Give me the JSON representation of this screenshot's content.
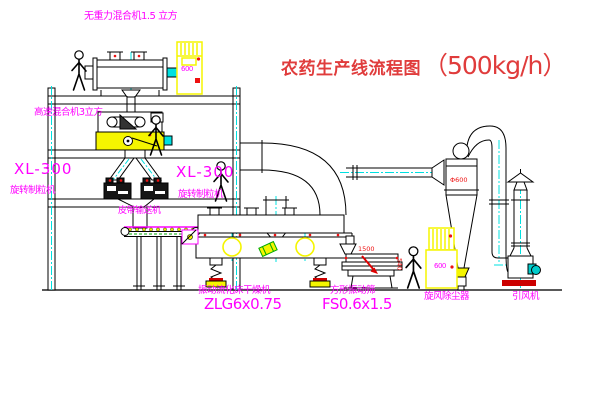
{
  "title": {
    "text": "农药生产线流程图",
    "capacity": "（500kg/h）"
  },
  "labels": {
    "gravity_mixer": "无重力混合机1.5 立方",
    "high_speed_mixer": "高速混合机3立方",
    "granulator_left_model": "XL-300",
    "granulator_left": "旋转制粒机",
    "granulator_mid_model": "XL-300",
    "granulator_mid": "旋转制粒机",
    "belt_conveyor": "皮带输送机",
    "dryer": "振动流化床干燥机",
    "dryer_model": "ZLG6x0.75",
    "sieve": "方形振动筛",
    "sieve_model": "FS0.6x1.5",
    "cyclone": "旋风除尘器",
    "fan": "引风机"
  },
  "dimensions": {
    "cyclone_dia": "Φ600",
    "sieve_len": "1500",
    "sieve_h": "540"
  },
  "cabinets": {
    "cabinet1": "600",
    "cabinet2": "600"
  },
  "colors": {
    "label_magenta": "#ff00ff",
    "title_red": "#e03c3c",
    "dim_red": "#ee1111",
    "accent_yellow": "#f5f500",
    "centerline_cyan": "#00e0e0",
    "conveyor_green": "#00aa00",
    "line_black": "#000000"
  }
}
